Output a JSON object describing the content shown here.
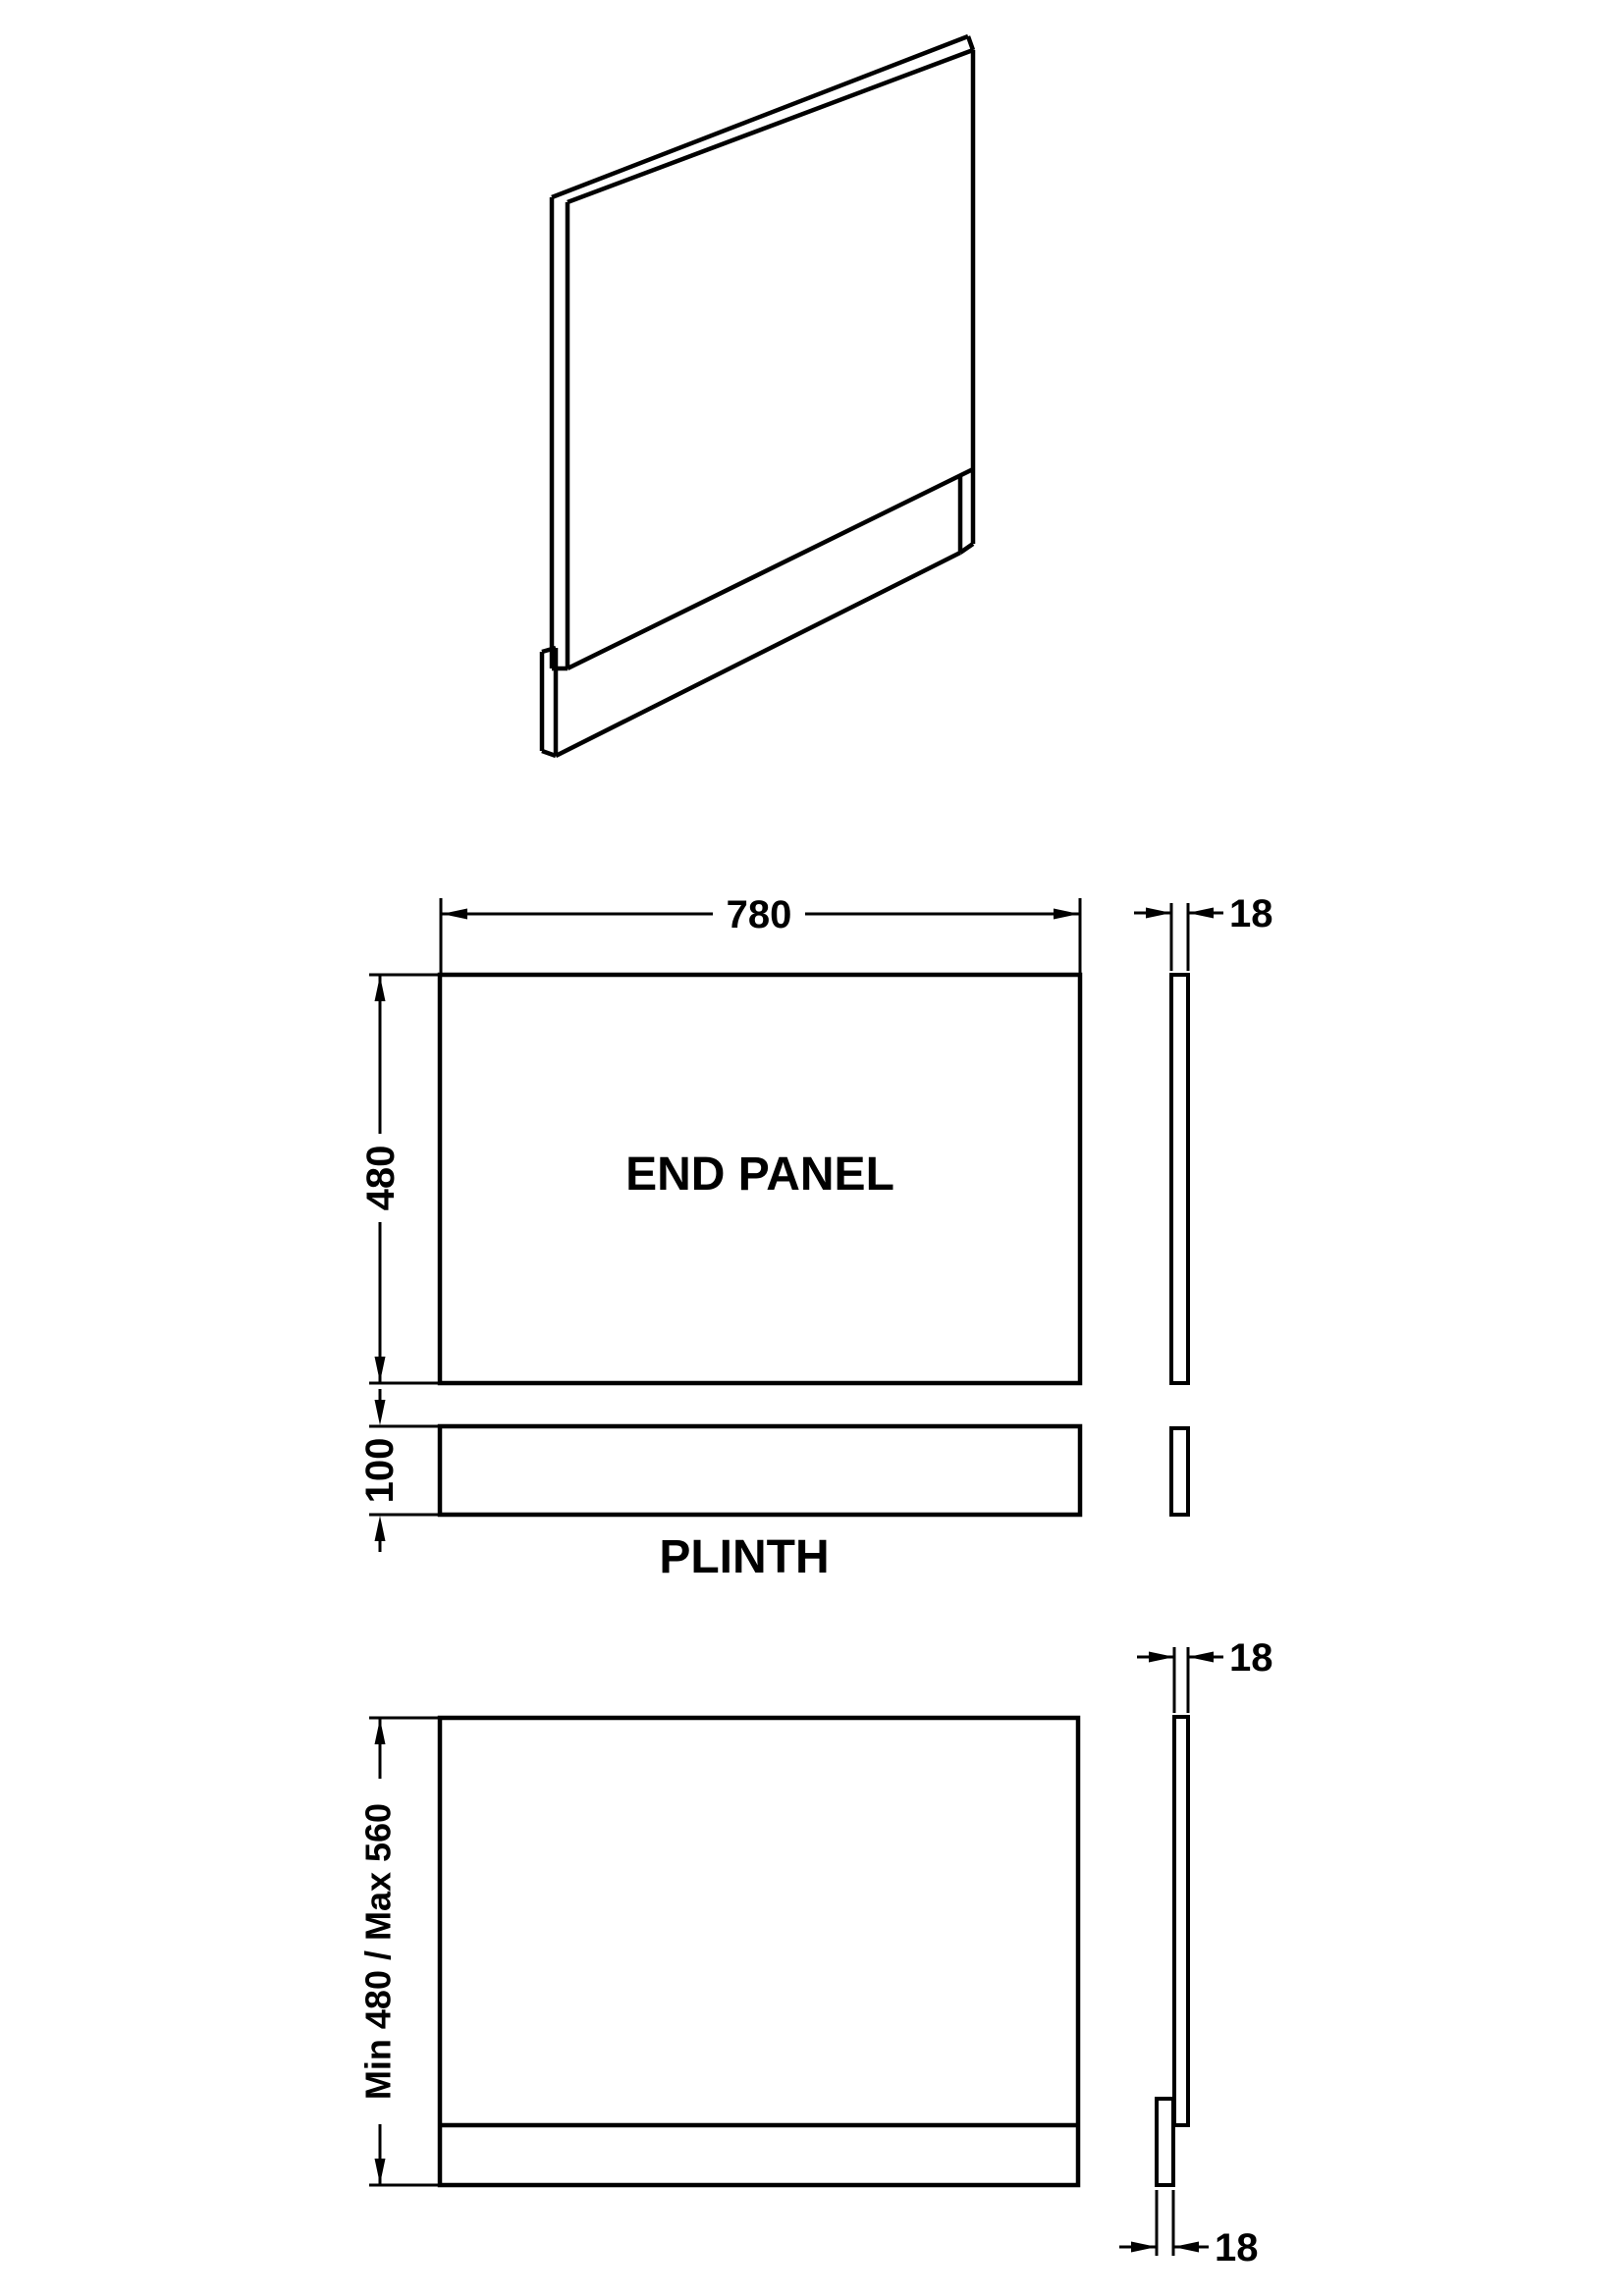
{
  "page": {
    "background": "#ffffff",
    "line_color": "#000000"
  },
  "labels": {
    "end_panel": "END PANEL",
    "plinth": "PLINTH"
  },
  "dimensions": {
    "panel_width": "780",
    "panel_height": "480",
    "panel_thickness": "18",
    "plinth_height": "100",
    "overall_height": "Min 480 / Max 560",
    "assembled_panel_thickness": "18",
    "assembled_plinth_thickness": "18"
  }
}
